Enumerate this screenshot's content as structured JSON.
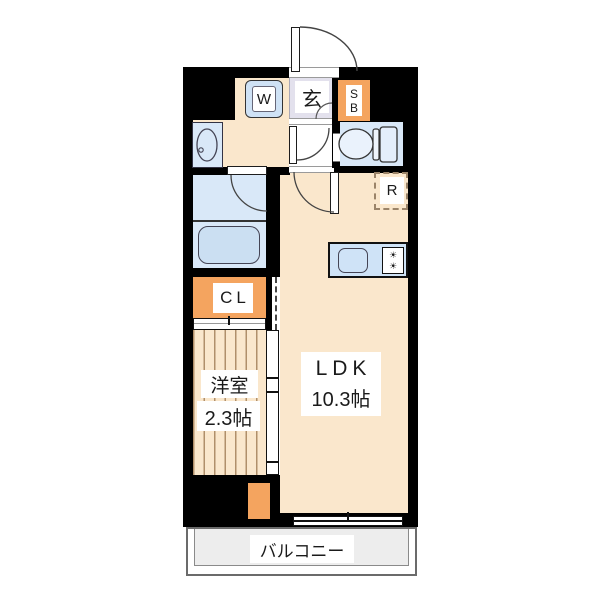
{
  "palette": {
    "wall": "#000000",
    "floor_cream": "#fae7cc",
    "water_blue": "#d9e8f8",
    "tub_blue": "#cbdff2",
    "counter_blue": "#cfe3f7",
    "entrance_lavender": "#e3e1ed",
    "storage_orange": "#f4a45f",
    "balcony_grey": "#ededed",
    "stripe_brown": "#b08f6a",
    "dashed_brown": "#9b8469"
  },
  "icons": {
    "stove_burner": "☀"
  },
  "plan": {
    "entrance_label": "玄",
    "washer_label": "W",
    "shoe_box": {
      "line1": "S",
      "line2": "B"
    },
    "closet_label": "CL",
    "refrigerator_label": "R",
    "western_room": {
      "name": "洋室",
      "size": "2.3帖"
    },
    "ldk": {
      "name": "LDK",
      "size": "10.3帖"
    },
    "balcony_label": "バルコニー"
  }
}
